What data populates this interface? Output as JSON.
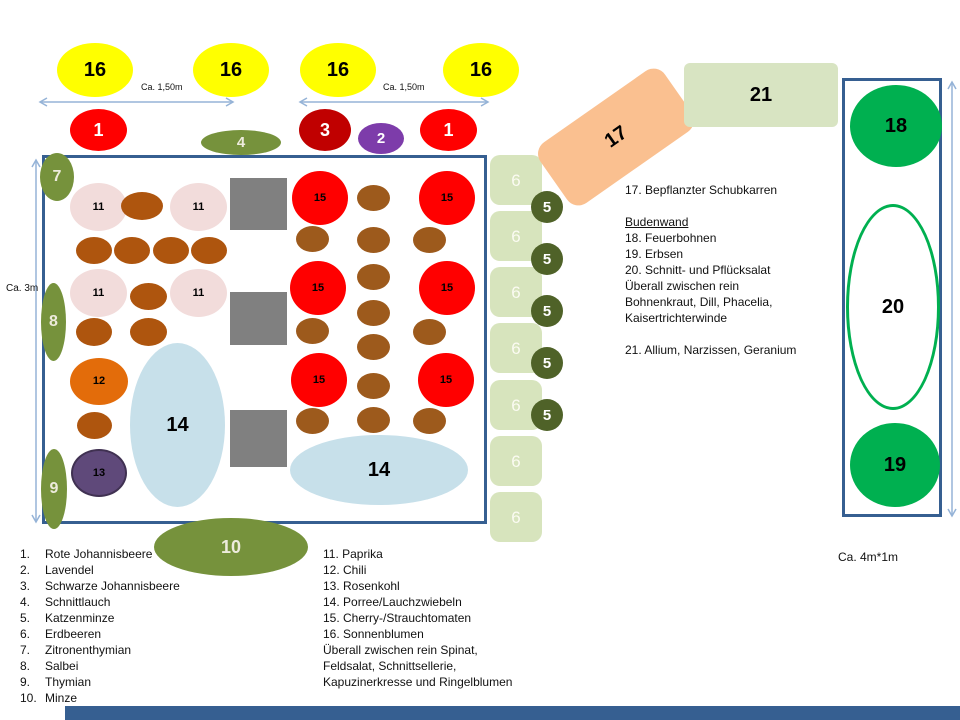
{
  "palette": {
    "arrow_blue": "#95B3D7",
    "bed_border_blue": "#365F91",
    "olive_green": "#76923C",
    "light_green": "#D7E4BD",
    "dark_olive": "#4F6228",
    "bright_green": "#00B050",
    "tomato_red": "#FF0000",
    "dark_red": "#C00000",
    "peach": "#FAC090",
    "pink": "#F2DCDB",
    "brown_left": "#AE550E",
    "brown_right": "#9D5A1C",
    "orange": "#E36C0A",
    "dark_purple": "#5F497A",
    "light_blue": "#C7E0EA",
    "gray": "#808080",
    "yellow": "#FFFF00"
  },
  "shapes": [
    {
      "n": "bottom-accent-bar",
      "s": "r",
      "x": 65,
      "y": 706,
      "w": 895,
      "h": 14,
      "f": "#365F91"
    },
    {
      "n": "main-bed-rect",
      "s": "r",
      "x": 42,
      "y": 155,
      "w": 445,
      "h": 369,
      "f": "#FFFFFF",
      "b": "3 #365F91"
    },
    {
      "n": "right-bed-rect",
      "s": "r",
      "x": 842,
      "y": 78,
      "w": 100,
      "h": 439,
      "f": "#FFFFFF",
      "b": "3 #365F91"
    },
    {
      "n": "erdbeeren-6-box-1",
      "s": "r",
      "x": 490,
      "y": 155,
      "w": 52,
      "h": 50,
      "r": 10,
      "f": "#D7E4BD",
      "l": "6",
      "c": "#FBFBF2",
      "fs": 17,
      "fw": 400
    },
    {
      "n": "erdbeeren-6-box-2",
      "s": "r",
      "x": 490,
      "y": 211,
      "w": 52,
      "h": 50,
      "r": 10,
      "f": "#D7E4BD",
      "l": "6",
      "c": "#FBFBF2",
      "fs": 17,
      "fw": 400
    },
    {
      "n": "erdbeeren-6-box-3",
      "s": "r",
      "x": 490,
      "y": 267,
      "w": 52,
      "h": 50,
      "r": 10,
      "f": "#D7E4BD",
      "l": "6",
      "c": "#FBFBF2",
      "fs": 17,
      "fw": 400
    },
    {
      "n": "erdbeeren-6-box-4",
      "s": "r",
      "x": 490,
      "y": 323,
      "w": 52,
      "h": 50,
      "r": 10,
      "f": "#D7E4BD",
      "l": "6",
      "c": "#FBFBF2",
      "fs": 17,
      "fw": 400
    },
    {
      "n": "erdbeeren-6-box-5",
      "s": "r",
      "x": 490,
      "y": 380,
      "w": 52,
      "h": 50,
      "r": 10,
      "f": "#D7E4BD",
      "l": "6",
      "c": "#FBFBF2",
      "fs": 17,
      "fw": 400
    },
    {
      "n": "erdbeeren-6-box-6",
      "s": "r",
      "x": 490,
      "y": 436,
      "w": 52,
      "h": 50,
      "r": 10,
      "f": "#D7E4BD",
      "l": "6",
      "c": "#FBFBF2",
      "fs": 17,
      "fw": 400
    },
    {
      "n": "erdbeeren-6-box-7",
      "s": "r",
      "x": 490,
      "y": 492,
      "w": 52,
      "h": 50,
      "r": 10,
      "f": "#D7E4BD",
      "l": "6",
      "c": "#FBFBF2",
      "fs": 17,
      "fw": 400
    },
    {
      "n": "schubkarren-17",
      "s": "r",
      "x": 540,
      "y": 100,
      "w": 152,
      "h": 74,
      "r": 14,
      "rot": -35,
      "f": "#FAC090",
      "l": "17",
      "c": "#000",
      "fs": 20
    },
    {
      "n": "beet-21",
      "s": "r",
      "x": 684,
      "y": 63,
      "w": 154,
      "h": 64,
      "r": 6,
      "f": "#D8E4C2",
      "l": "21",
      "c": "#000",
      "fs": 20
    },
    {
      "n": "katzenminze-5-1",
      "s": "e",
      "x": 531,
      "y": 191,
      "w": 32,
      "h": 32,
      "f": "#4F6228",
      "l": "5",
      "c": "#fff",
      "fs": 15
    },
    {
      "n": "katzenminze-5-2",
      "s": "e",
      "x": 531,
      "y": 243,
      "w": 32,
      "h": 32,
      "f": "#4F6228",
      "l": "5",
      "c": "#fff",
      "fs": 15
    },
    {
      "n": "katzenminze-5-3",
      "s": "e",
      "x": 531,
      "y": 295,
      "w": 32,
      "h": 32,
      "f": "#4F6228",
      "l": "5",
      "c": "#fff",
      "fs": 15
    },
    {
      "n": "katzenminze-5-4",
      "s": "e",
      "x": 531,
      "y": 347,
      "w": 32,
      "h": 32,
      "f": "#4F6228",
      "l": "5",
      "c": "#fff",
      "fs": 15
    },
    {
      "n": "katzenminze-5-5",
      "s": "e",
      "x": 531,
      "y": 399,
      "w": 32,
      "h": 32,
      "f": "#4F6228",
      "l": "5",
      "c": "#fff",
      "fs": 15
    },
    {
      "n": "sonnenblume-16-1",
      "s": "e",
      "x": 57,
      "y": 43,
      "w": 76,
      "h": 54,
      "f": "#FFFF00",
      "l": "16",
      "c": "#000",
      "fs": 20
    },
    {
      "n": "sonnenblume-16-2",
      "s": "e",
      "x": 193,
      "y": 43,
      "w": 76,
      "h": 54,
      "f": "#FFFF00",
      "l": "16",
      "c": "#000",
      "fs": 20
    },
    {
      "n": "sonnenblume-16-3",
      "s": "e",
      "x": 300,
      "y": 43,
      "w": 76,
      "h": 54,
      "f": "#FFFF00",
      "l": "16",
      "c": "#000",
      "fs": 20
    },
    {
      "n": "sonnenblume-16-4",
      "s": "e",
      "x": 443,
      "y": 43,
      "w": 76,
      "h": 54,
      "f": "#FFFF00",
      "l": "16",
      "c": "#000",
      "fs": 20
    },
    {
      "n": "johannisbeere-1-links",
      "s": "e",
      "x": 70,
      "y": 109,
      "w": 57,
      "h": 42,
      "f": "#FF0000",
      "l": "1",
      "c": "#fff",
      "fs": 18
    },
    {
      "n": "schnittlauch-4",
      "s": "e",
      "x": 201,
      "y": 130,
      "w": 80,
      "h": 25,
      "f": "#76923C",
      "l": "4",
      "c": "#EDEBDC",
      "fs": 15
    },
    {
      "n": "schwarze-johannisbeere-3",
      "s": "e",
      "x": 299,
      "y": 109,
      "w": 52,
      "h": 42,
      "f": "#C00000",
      "l": "3",
      "c": "#fff",
      "fs": 18
    },
    {
      "n": "lavendel-2",
      "s": "e",
      "x": 358,
      "y": 123,
      "w": 46,
      "h": 31,
      "f": "#7D3CAA",
      "l": "2",
      "c": "#fff",
      "fs": 15
    },
    {
      "n": "johannisbeere-1-rechts",
      "s": "e",
      "x": 420,
      "y": 109,
      "w": 57,
      "h": 42,
      "f": "#FF0000",
      "l": "1",
      "c": "#fff",
      "fs": 18
    },
    {
      "n": "paprika-11-1",
      "s": "e",
      "x": 70,
      "y": 183,
      "w": 57,
      "h": 48,
      "f": "#F2DCDB",
      "l": "11",
      "c": "#000",
      "fs": 11
    },
    {
      "n": "paprika-11-2",
      "s": "e",
      "x": 170,
      "y": 183,
      "w": 57,
      "h": 48,
      "f": "#F2DCDB",
      "l": "11",
      "c": "#000",
      "fs": 11
    },
    {
      "n": "paprika-11-3",
      "s": "e",
      "x": 70,
      "y": 269,
      "w": 57,
      "h": 48,
      "f": "#F2DCDB",
      "l": "11",
      "c": "#000",
      "fs": 11
    },
    {
      "n": "paprika-11-4",
      "s": "e",
      "x": 170,
      "y": 269,
      "w": 57,
      "h": 48,
      "f": "#F2DCDB",
      "l": "11",
      "c": "#000",
      "fs": 11
    },
    {
      "n": "brown-plant",
      "s": "e",
      "x": 121,
      "y": 192,
      "w": 42,
      "h": 28,
      "f": "#AE550E"
    },
    {
      "n": "brown-plant",
      "s": "e",
      "x": 76,
      "y": 237,
      "w": 36,
      "h": 27,
      "f": "#AE550E"
    },
    {
      "n": "brown-plant",
      "s": "e",
      "x": 114,
      "y": 237,
      "w": 36,
      "h": 27,
      "f": "#AE550E"
    },
    {
      "n": "brown-plant",
      "s": "e",
      "x": 153,
      "y": 237,
      "w": 36,
      "h": 27,
      "f": "#AE550E"
    },
    {
      "n": "brown-plant",
      "s": "e",
      "x": 191,
      "y": 237,
      "w": 36,
      "h": 27,
      "f": "#AE550E"
    },
    {
      "n": "brown-plant",
      "s": "e",
      "x": 130,
      "y": 283,
      "w": 37,
      "h": 27,
      "f": "#AE550E"
    },
    {
      "n": "brown-plant",
      "s": "e",
      "x": 76,
      "y": 318,
      "w": 36,
      "h": 28,
      "f": "#AE550E"
    },
    {
      "n": "brown-plant",
      "s": "e",
      "x": 130,
      "y": 318,
      "w": 37,
      "h": 28,
      "f": "#AE550E"
    },
    {
      "n": "chili-12",
      "s": "e",
      "x": 70,
      "y": 358,
      "w": 58,
      "h": 47,
      "f": "#E36C0A",
      "l": "12",
      "c": "#000",
      "fs": 11
    },
    {
      "n": "brown-plant",
      "s": "e",
      "x": 77,
      "y": 412,
      "w": 35,
      "h": 27,
      "f": "#AE550E"
    },
    {
      "n": "rosenkohl-13",
      "s": "e",
      "x": 71,
      "y": 449,
      "w": 56,
      "h": 48,
      "f": "#5F497A",
      "b": "2 #403152",
      "l": "13",
      "c": "#000",
      "fs": 11
    },
    {
      "n": "porree-14-links",
      "s": "e",
      "x": 130,
      "y": 343,
      "w": 95,
      "h": 164,
      "f": "#C7E0EA",
      "l": "14",
      "c": "#000",
      "fs": 20
    },
    {
      "n": "porree-14-rechts",
      "s": "e",
      "x": 290,
      "y": 435,
      "w": 178,
      "h": 70,
      "f": "#C7E0EA",
      "l": "14",
      "c": "#000",
      "fs": 20
    },
    {
      "n": "gray-square",
      "s": "r",
      "x": 230,
      "y": 178,
      "w": 57,
      "h": 52,
      "f": "#808080"
    },
    {
      "n": "gray-square",
      "s": "r",
      "x": 230,
      "y": 292,
      "w": 57,
      "h": 53,
      "f": "#808080"
    },
    {
      "n": "gray-square",
      "s": "r",
      "x": 230,
      "y": 410,
      "w": 57,
      "h": 57,
      "f": "#808080"
    },
    {
      "n": "tomate-15-1",
      "s": "e",
      "x": 292,
      "y": 171,
      "w": 56,
      "h": 54,
      "f": "#FF0000",
      "l": "15",
      "c": "#000",
      "fs": 11
    },
    {
      "n": "tomate-15-2",
      "s": "e",
      "x": 419,
      "y": 171,
      "w": 56,
      "h": 54,
      "f": "#FF0000",
      "l": "15",
      "c": "#000",
      "fs": 11
    },
    {
      "n": "tomate-15-3",
      "s": "e",
      "x": 290,
      "y": 261,
      "w": 56,
      "h": 54,
      "f": "#FF0000",
      "l": "15",
      "c": "#000",
      "fs": 11
    },
    {
      "n": "tomate-15-4",
      "s": "e",
      "x": 419,
      "y": 261,
      "w": 56,
      "h": 54,
      "f": "#FF0000",
      "l": "15",
      "c": "#000",
      "fs": 11
    },
    {
      "n": "tomate-15-5",
      "s": "e",
      "x": 291,
      "y": 353,
      "w": 56,
      "h": 54,
      "f": "#FF0000",
      "l": "15",
      "c": "#000",
      "fs": 11
    },
    {
      "n": "tomate-15-6",
      "s": "e",
      "x": 418,
      "y": 353,
      "w": 56,
      "h": 54,
      "f": "#FF0000",
      "l": "15",
      "c": "#000",
      "fs": 11
    },
    {
      "n": "brown-plant",
      "s": "e",
      "x": 357,
      "y": 185,
      "w": 33,
      "h": 26,
      "f": "#9D5A1C"
    },
    {
      "n": "brown-plant",
      "s": "e",
      "x": 357,
      "y": 227,
      "w": 33,
      "h": 26,
      "f": "#9D5A1C"
    },
    {
      "n": "brown-plant",
      "s": "e",
      "x": 357,
      "y": 264,
      "w": 33,
      "h": 26,
      "f": "#9D5A1C"
    },
    {
      "n": "brown-plant",
      "s": "e",
      "x": 357,
      "y": 300,
      "w": 33,
      "h": 26,
      "f": "#9D5A1C"
    },
    {
      "n": "brown-plant",
      "s": "e",
      "x": 357,
      "y": 334,
      "w": 33,
      "h": 26,
      "f": "#9D5A1C"
    },
    {
      "n": "brown-plant",
      "s": "e",
      "x": 357,
      "y": 373,
      "w": 33,
      "h": 26,
      "f": "#9D5A1C"
    },
    {
      "n": "brown-plant",
      "s": "e",
      "x": 357,
      "y": 407,
      "w": 33,
      "h": 26,
      "f": "#9D5A1C"
    },
    {
      "n": "brown-plant",
      "s": "e",
      "x": 296,
      "y": 226,
      "w": 33,
      "h": 26,
      "f": "#9D5A1C"
    },
    {
      "n": "brown-plant",
      "s": "e",
      "x": 296,
      "y": 318,
      "w": 33,
      "h": 26,
      "f": "#9D5A1C"
    },
    {
      "n": "brown-plant",
      "s": "e",
      "x": 296,
      "y": 408,
      "w": 33,
      "h": 26,
      "f": "#9D5A1C"
    },
    {
      "n": "brown-plant",
      "s": "e",
      "x": 413,
      "y": 227,
      "w": 33,
      "h": 26,
      "f": "#9D5A1C"
    },
    {
      "n": "brown-plant",
      "s": "e",
      "x": 413,
      "y": 319,
      "w": 33,
      "h": 26,
      "f": "#9D5A1C"
    },
    {
      "n": "brown-plant",
      "s": "e",
      "x": 413,
      "y": 408,
      "w": 33,
      "h": 26,
      "f": "#9D5A1C"
    },
    {
      "n": "zitronenthymian-7",
      "s": "e",
      "x": 40,
      "y": 153,
      "w": 34,
      "h": 48,
      "f": "#76923C",
      "l": "7",
      "c": "#EDEBDC",
      "fs": 16
    },
    {
      "n": "salbei-8",
      "s": "e",
      "x": 41,
      "y": 283,
      "w": 25,
      "h": 78,
      "f": "#76923C",
      "l": "8",
      "c": "#EDEBDC",
      "fs": 16
    },
    {
      "n": "thymian-9",
      "s": "e",
      "x": 41,
      "y": 449,
      "w": 26,
      "h": 80,
      "f": "#76923C",
      "l": "9",
      "c": "#EDEBDC",
      "fs": 16
    },
    {
      "n": "minze-10",
      "s": "e",
      "x": 154,
      "y": 518,
      "w": 154,
      "h": 58,
      "f": "#76923C",
      "l": "10",
      "c": "#EDEBDC",
      "fs": 18
    },
    {
      "n": "feuerbohnen-18",
      "s": "e",
      "x": 850,
      "y": 85,
      "w": 92,
      "h": 82,
      "f": "#00B050",
      "l": "18",
      "c": "#000",
      "fs": 20
    },
    {
      "n": "pfluecksalat-20",
      "s": "e",
      "x": 846,
      "y": 204,
      "w": 94,
      "h": 206,
      "f": "#FFFFFF",
      "b": "3 #00B050",
      "l": "20",
      "c": "#000",
      "fs": 20
    },
    {
      "n": "erbsen-19",
      "s": "e",
      "x": 850,
      "y": 423,
      "w": 90,
      "h": 84,
      "f": "#00B050",
      "l": "19",
      "c": "#000",
      "fs": 20
    }
  ],
  "arrows": [
    {
      "n": "measure-arrow-top-left",
      "x1": 40,
      "y1": 102,
      "x2": 233,
      "y2": 102,
      "label": "Ca. 1,50m",
      "lx": 141,
      "ly": 82,
      "lfs": 9
    },
    {
      "n": "measure-arrow-top-right",
      "x1": 300,
      "y1": 102,
      "x2": 488,
      "y2": 102,
      "label": "Ca. 1,50m",
      "lx": 383,
      "ly": 82,
      "lfs": 9
    },
    {
      "n": "measure-arrow-left",
      "x1": 36,
      "y1": 160,
      "x2": 36,
      "y2": 522,
      "label": "Ca. 3m",
      "lx": 6,
      "ly": 283,
      "lfs": 10
    },
    {
      "n": "measure-arrow-right",
      "x1": 952,
      "y1": 82,
      "x2": 952,
      "y2": 516,
      "label": "Ca. 4m*1m",
      "lx": 838,
      "ly": 550,
      "lfs": 12
    }
  ],
  "legend_left": [
    {
      "n": "1.",
      "t": "Rote Johannisbeere"
    },
    {
      "n": "2.",
      "t": "Lavendel"
    },
    {
      "n": "3.",
      "t": "Schwarze Johannisbeere"
    },
    {
      "n": "4.",
      "t": "Schnittlauch"
    },
    {
      "n": "5.",
      "t": "Katzenminze"
    },
    {
      "n": "6.",
      "t": "Erdbeeren"
    },
    {
      "n": "7.",
      "t": "Zitronenthymian"
    },
    {
      "n": "8.",
      "t": "Salbei"
    },
    {
      "n": "9.",
      "t": "Thymian"
    },
    {
      "n": "10.",
      "t": "Minze"
    }
  ],
  "legend_right": [
    "11. Paprika",
    "12. Chili",
    "13. Rosenkohl",
    "14. Porree/Lauchzwiebeln",
    "15. Cherry-/Strauchtomaten",
    "16. Sonnenblumen",
    "Überall zwischen rein Spinat,",
    "Feldsalat, Schnittsellerie,",
    "Kapuzinerkresse und Ringelblumen"
  ],
  "info_block": [
    "17. Bepflanzter Schubkarren",
    "",
    {
      "t": "Budenwand",
      "u": true
    },
    "18. Feuerbohnen",
    "19. Erbsen",
    "20. Schnitt- und Pflücksalat",
    "Überall zwischen rein",
    "Bohnenkraut, Dill, Phacelia,",
    "Kaisertrichterwinde",
    "",
    "21. Allium, Narzissen, Geranium"
  ]
}
